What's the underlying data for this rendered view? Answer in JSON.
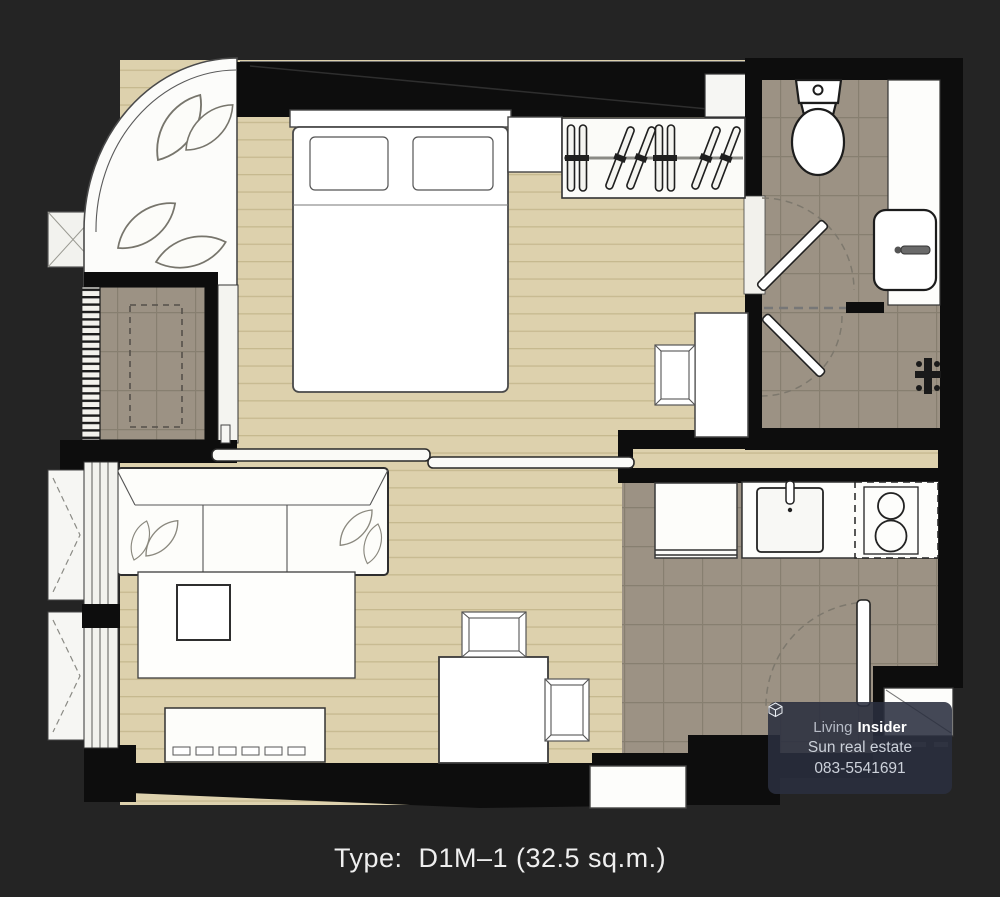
{
  "title": {
    "label": "Type:  D1M–1 (32.5 sq.m.)"
  },
  "watermark": {
    "brand_prefix": "Living",
    "brand_suffix": "Insider",
    "agent": "Sun real estate",
    "phone": "083-5541691"
  },
  "plan": {
    "unit_type": "D1M-1",
    "area": "32.5 sq.m.",
    "rooms": [
      {
        "name": "bedroom",
        "furniture": [
          "double-bed",
          "pillows",
          "headboard",
          "nightstand",
          "wardrobe-with-hangers",
          "desk",
          "desk-chair"
        ]
      },
      {
        "name": "bathroom",
        "furniture": [
          "toilet",
          "vanity-counter",
          "sink-basin",
          "swing-door",
          "shower-door",
          "shower-valve"
        ]
      },
      {
        "name": "living-dining",
        "furniture": [
          "3-seat-sofa",
          "rug",
          "coffee-table",
          "tv-console",
          "dining-table",
          "dining-chair-top",
          "dining-chair-right"
        ]
      },
      {
        "name": "kitchen",
        "furniture": [
          "refrigerator",
          "kitchen-sink",
          "stove-2-burner",
          "entrance-door",
          "entry-mat"
        ]
      },
      {
        "name": "balcony-bay",
        "furniture": [
          "plants"
        ]
      },
      {
        "name": "ac-ledge",
        "furniture": [
          "condenser-unit",
          "louver-vent"
        ]
      }
    ],
    "doors": [
      "sliding-partition-door",
      "bathroom-swing-door",
      "shower-swing-door",
      "entrance-swing-door"
    ],
    "windows": [
      "curved-corner-glazing",
      "left-casement-window-1",
      "left-casement-window-2"
    ]
  },
  "colors": {
    "background": "#242424",
    "wall": "#0d0d0d",
    "wood_floor": "#ddd1ad",
    "wood_plank_line": "#c6b98f",
    "tile_floor": "#9c9284",
    "tile_line": "#877f70",
    "furniture_white": "#fdfdfa",
    "watermark_bg": "rgba(42,47,63,0.88)",
    "title_text": "#efefef"
  }
}
